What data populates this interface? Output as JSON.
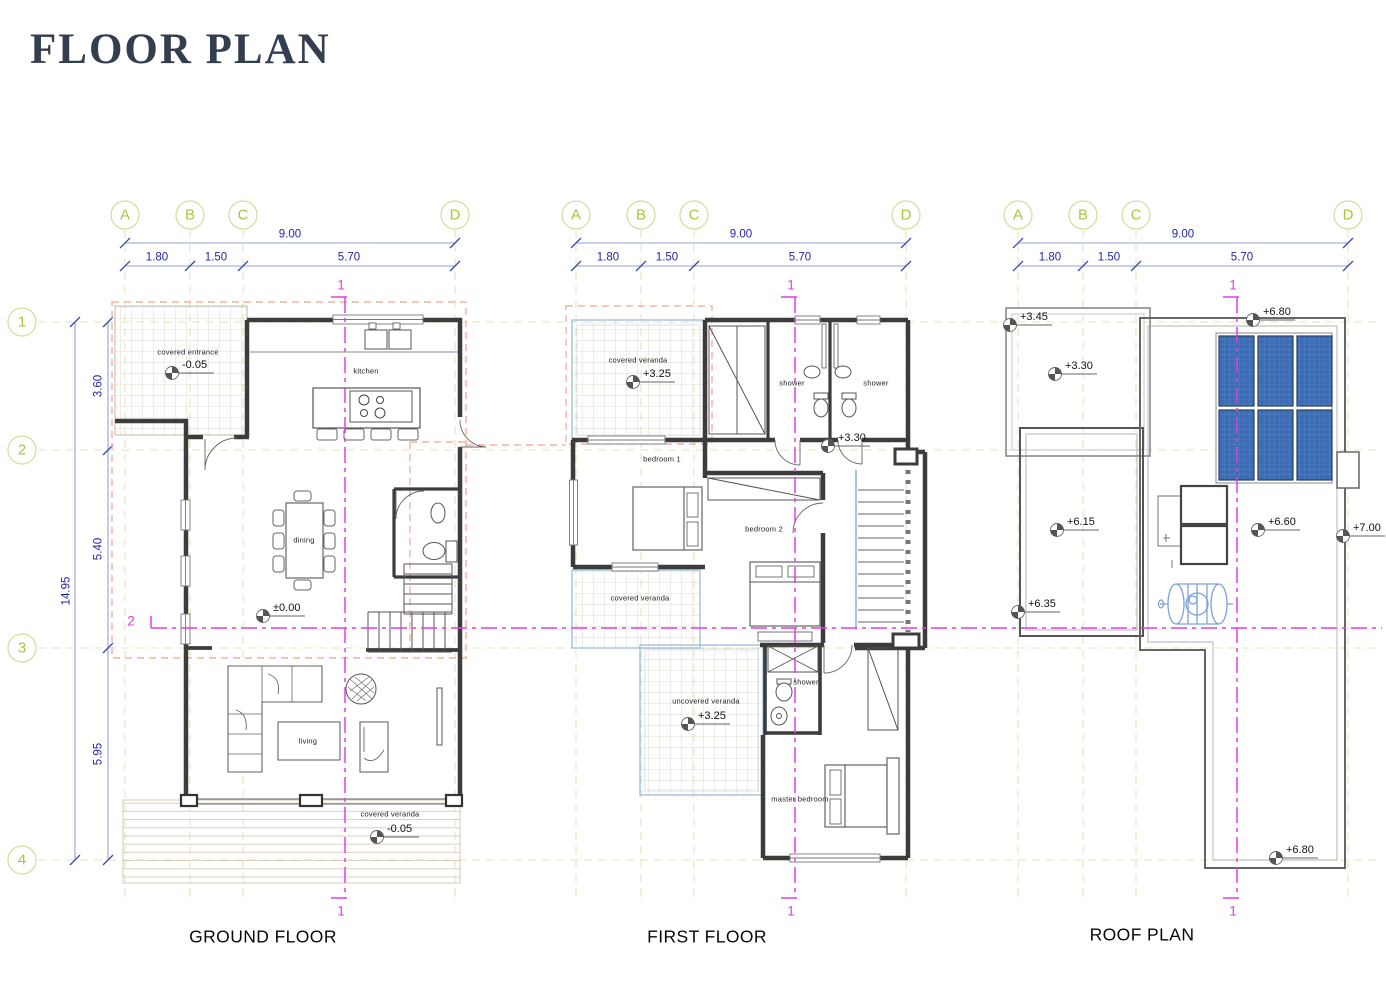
{
  "sheet": {
    "title": "FLOOR PLAN"
  },
  "grid": {
    "letters": [
      "A",
      "B",
      "C",
      "D"
    ],
    "rows": [
      "1",
      "2",
      "3",
      "4"
    ],
    "top": {
      "total": "9.00",
      "seg1": "1.80",
      "seg2": "1.50",
      "seg3": "5.70"
    },
    "left": {
      "total": "14.95",
      "seg1": "3.60",
      "seg2": "5.40",
      "seg3": "5.95"
    }
  },
  "sections": {
    "line1": "1",
    "line2": "2"
  },
  "ground": {
    "label": "GROUND FLOOR",
    "covered_entrance": "covered entrance",
    "covered_entrance_level": "-0.05",
    "kitchen": "kitchen",
    "dining": "dining",
    "floor_level": "±0.00",
    "living": "living",
    "covered_veranda": "covered veranda",
    "covered_veranda_level": "-0.05"
  },
  "first": {
    "label": "FIRST FLOOR",
    "covered_veranda_top": "covered veranda",
    "covered_veranda_top_level": "+3.25",
    "shower_a": "shower",
    "shower_b": "shower",
    "hall_level": "+3.30",
    "bedroom1": "bedroom 1",
    "bedroom2": "bedroom 2",
    "covered_veranda_mid": "covered veranda",
    "uncovered_veranda": "uncovered veranda",
    "uncovered_veranda_level": "+3.25",
    "shower_c": "shower",
    "master_bedroom": "master bedroom"
  },
  "roof": {
    "label": "ROOF PLAN",
    "level_345": "+3.45",
    "level_680_top": "+6.80",
    "level_330": "+3.30",
    "level_615": "+6.15",
    "level_660": "+6.60",
    "level_700": "+7.00",
    "level_635": "+6.35",
    "level_680_bottom": "+6.80"
  },
  "icons": {
    "level_marker": "benchmark-level-icon",
    "grid_bubble": "grid-axis-bubble"
  },
  "colors": {
    "title": "#333e4e",
    "grid_marker": "#a2c93e",
    "grid_line": "#e2e5b8",
    "dimension": "#2224a8",
    "section_line": "#e23ee2",
    "wall": "#3c3c3c",
    "roof_overhang_dash": "#f0a392",
    "veranda_edge": "#9bbdd8",
    "solar_panel": "#3c6cb4",
    "water_tank": "#7ba3d8"
  }
}
